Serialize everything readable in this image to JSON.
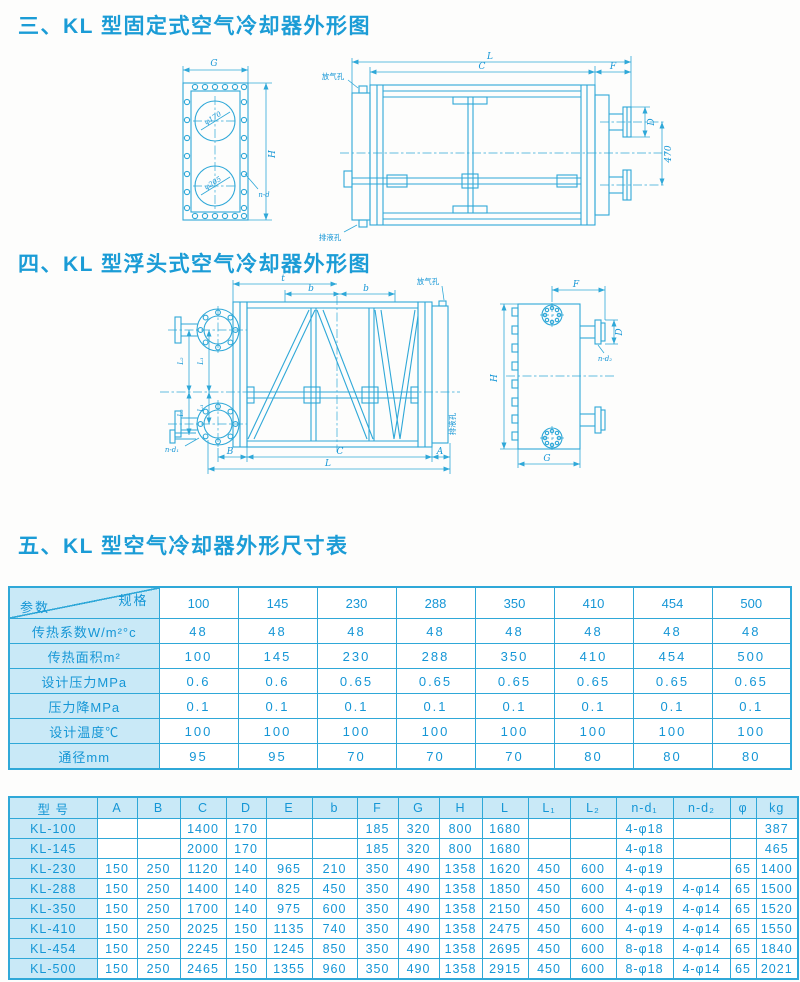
{
  "page": {
    "accent": "#1b9cd6",
    "line_color": "#2fa8d8",
    "cell_bg": "#c9e9f7"
  },
  "sections": {
    "s3": "三、KL 型固定式空气冷却器外形图",
    "s4": "四、KL 型浮头式空气冷却器外形图",
    "s5": "五、KL 型空气冷却器外形尺寸表"
  },
  "drawing_fixed": {
    "front": {
      "dim_g": "G",
      "dim_h": "H",
      "hole_label": "n-d",
      "top_circle_label": "φ170",
      "bottom_circle_label": "φ205"
    },
    "side": {
      "dim_l": "L",
      "dim_c": "C",
      "dim_f": "F",
      "dim_d": "D",
      "dim_470": "470",
      "vent_label": "放气孔",
      "drain_label": "排液孔"
    }
  },
  "drawing_floating": {
    "front": {
      "dim_t": "t",
      "dim_b1": "b",
      "dim_b2": "b",
      "vent_label": "放气孔",
      "drain_label": "排液孔",
      "dim_l1": "L₁",
      "dim_l1b": "L₁",
      "dim_l2": "L₂",
      "dim_l2b": "L₂",
      "hole_label": "n-d₁",
      "dim_B": "B",
      "dim_C": "C",
      "dim_A": "A",
      "dim_L": "L"
    },
    "side": {
      "dim_f": "F",
      "dim_d": "D",
      "hole_label": "n-d₂",
      "dim_h": "H",
      "dim_g": "G"
    }
  },
  "table1": {
    "corner": {
      "top": "规格",
      "bottom": "参数"
    },
    "columns": [
      "100",
      "145",
      "230",
      "288",
      "350",
      "410",
      "454",
      "500"
    ],
    "rows": [
      {
        "label": "传热系数W/m²°c",
        "values": [
          "48",
          "48",
          "48",
          "48",
          "48",
          "48",
          "48",
          "48"
        ]
      },
      {
        "label": "传热面积m²",
        "values": [
          "100",
          "145",
          "230",
          "288",
          "350",
          "410",
          "454",
          "500"
        ]
      },
      {
        "label": "设计压力MPa",
        "values": [
          "0.6",
          "0.6",
          "0.65",
          "0.65",
          "0.65",
          "0.65",
          "0.65",
          "0.65"
        ]
      },
      {
        "label": "压力降MPa",
        "values": [
          "0.1",
          "0.1",
          "0.1",
          "0.1",
          "0.1",
          "0.1",
          "0.1",
          "0.1"
        ]
      },
      {
        "label": "设计温度℃",
        "values": [
          "100",
          "100",
          "100",
          "100",
          "100",
          "100",
          "100",
          "100"
        ]
      },
      {
        "label": "通径mm",
        "values": [
          "95",
          "95",
          "70",
          "70",
          "70",
          "80",
          "80",
          "80"
        ]
      }
    ]
  },
  "table2": {
    "headers": [
      "型  号",
      "A",
      "B",
      "C",
      "D",
      "E",
      "b",
      "F",
      "G",
      "H",
      "L",
      "L₁",
      "L₂",
      "n-d₁",
      "n-d₂",
      "φ",
      "kg"
    ],
    "rows": [
      {
        "model": "KL-100",
        "values": [
          "",
          "",
          "1400",
          "170",
          "",
          "",
          "185",
          "320",
          "800",
          "1680",
          "",
          "",
          "4-φ18",
          "",
          "",
          "387"
        ]
      },
      {
        "model": "KL-145",
        "values": [
          "",
          "",
          "2000",
          "170",
          "",
          "",
          "185",
          "320",
          "800",
          "1680",
          "",
          "",
          "4-φ18",
          "",
          "",
          "465"
        ]
      },
      {
        "model": "KL-230",
        "values": [
          "150",
          "250",
          "1120",
          "140",
          "965",
          "210",
          "350",
          "490",
          "1358",
          "1620",
          "450",
          "600",
          "4-φ19",
          "",
          "65",
          "1400"
        ]
      },
      {
        "model": "KL-288",
        "values": [
          "150",
          "250",
          "1400",
          "140",
          "825",
          "450",
          "350",
          "490",
          "1358",
          "1850",
          "450",
          "600",
          "4-φ19",
          "4-φ14",
          "65",
          "1500"
        ]
      },
      {
        "model": "KL-350",
        "values": [
          "150",
          "250",
          "1700",
          "140",
          "975",
          "600",
          "350",
          "490",
          "1358",
          "2150",
          "450",
          "600",
          "4-φ19",
          "4-φ14",
          "65",
          "1520"
        ]
      },
      {
        "model": "KL-410",
        "values": [
          "150",
          "250",
          "2025",
          "150",
          "1135",
          "740",
          "350",
          "490",
          "1358",
          "2475",
          "450",
          "600",
          "4-φ19",
          "4-φ14",
          "65",
          "1550"
        ]
      },
      {
        "model": "KL-454",
        "values": [
          "150",
          "250",
          "2245",
          "150",
          "1245",
          "850",
          "350",
          "490",
          "1358",
          "2695",
          "450",
          "600",
          "8-φ18",
          "4-φ14",
          "65",
          "1840"
        ]
      },
      {
        "model": "KL-500",
        "values": [
          "150",
          "250",
          "2465",
          "150",
          "1355",
          "960",
          "350",
          "490",
          "1358",
          "2915",
          "450",
          "600",
          "8-φ18",
          "4-φ14",
          "65",
          "2021"
        ]
      }
    ]
  }
}
